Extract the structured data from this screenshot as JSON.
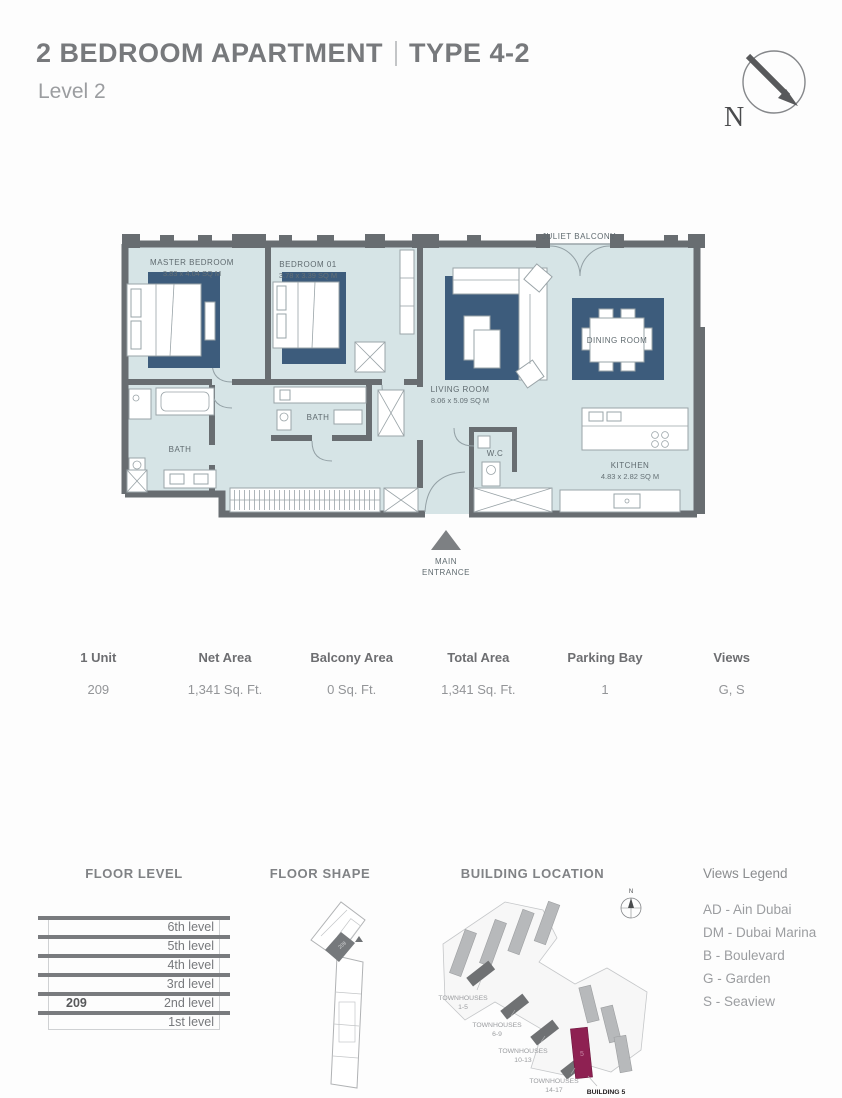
{
  "header": {
    "title_main": "2 BEDROOM APARTMENT",
    "title_type": "TYPE 4-2",
    "subtitle": "Level 2",
    "compass_n": "N"
  },
  "floor_plan": {
    "juliet_balcony": "JULIET BALCONY",
    "master_bedroom": {
      "name": "MASTER BEDROOM",
      "dims": "3.83 x 4.04 SQ M"
    },
    "bedroom_01": {
      "name": "BEDROOM 01",
      "dims": "3.78 x 3.39 SQ M"
    },
    "living_room": {
      "name": "LIVING ROOM",
      "dims": "8.06 x 5.09 SQ M"
    },
    "dining_room": {
      "name": "DINING ROOM"
    },
    "kitchen": {
      "name": "KITCHEN",
      "dims": "4.83 x 2.82 SQ M"
    },
    "bath_1": "BATH",
    "bath_2": "BATH",
    "wc": "W.C",
    "entrance_l1": "MAIN",
    "entrance_l2": "ENTRANCE"
  },
  "unit_table": {
    "columns": [
      "1 Unit",
      "Net Area",
      "Balcony Area",
      "Total Area",
      "Parking Bay",
      "Views"
    ],
    "row": [
      "209",
      "1,341 Sq. Ft.",
      "0 Sq. Ft.",
      "1,341 Sq. Ft.",
      "1",
      "G, S"
    ]
  },
  "floor_level": {
    "title": "FLOOR LEVEL",
    "levels": [
      "6th level",
      "5th level",
      "4th level",
      "3rd level",
      "2nd level",
      "1st level"
    ],
    "unit_number": "209"
  },
  "floor_shape": {
    "title": "FLOOR SHAPE",
    "unit_number": "209"
  },
  "building_location": {
    "title": "BUILDING LOCATION",
    "compass_n": "N",
    "townhouses": [
      {
        "label": "TOWNHOUSES",
        "range": "1-5"
      },
      {
        "label": "TOWNHOUSES",
        "range": "6-9"
      },
      {
        "label": "TOWNHOUSES",
        "range": "10-13"
      },
      {
        "label": "TOWNHOUSES",
        "range": "14-17"
      }
    ],
    "building_label": "BUILDING 5",
    "highlight_number": "5"
  },
  "views_legend": {
    "title": "Views Legend",
    "items": [
      "AD - Ain Dubai",
      "DM - Dubai Marina",
      "B - Boulevard",
      "G - Garden",
      "S - Seaview"
    ]
  },
  "colors": {
    "wall": "#686d71",
    "floor": "#d6e4e6",
    "rug": "#3d5c7c",
    "highlight_building": "#8e2152",
    "bar": "#797b7e"
  }
}
